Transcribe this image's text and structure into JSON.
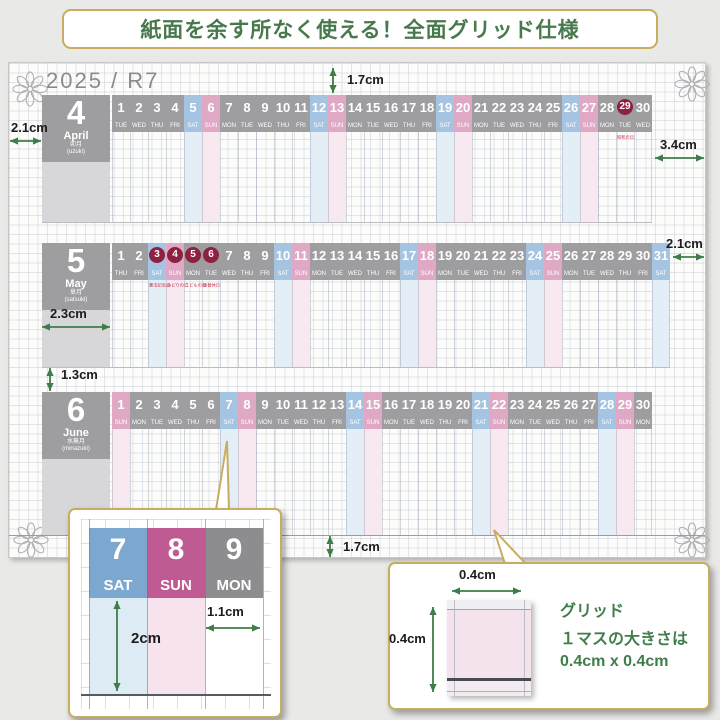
{
  "banner": {
    "text": "紙面を余す所なく使える！全面グリッド仕様"
  },
  "calendar": {
    "year_label": "2025 / R7",
    "months": [
      {
        "num": "4",
        "name_en": "April",
        "name_jp": "卯月",
        "name_romaji": "(uzuki)",
        "holidays": {
          "29": "昭和の日"
        },
        "days": [
          [
            1,
            "TUE"
          ],
          [
            2,
            "WED"
          ],
          [
            3,
            "THU"
          ],
          [
            4,
            "FRI"
          ],
          [
            5,
            "SAT"
          ],
          [
            6,
            "SUN"
          ],
          [
            7,
            "MON"
          ],
          [
            8,
            "TUE"
          ],
          [
            9,
            "WED"
          ],
          [
            10,
            "THU"
          ],
          [
            11,
            "FRI"
          ],
          [
            12,
            "SAT"
          ],
          [
            13,
            "SUN"
          ],
          [
            14,
            "MON"
          ],
          [
            15,
            "TUE"
          ],
          [
            16,
            "WED"
          ],
          [
            17,
            "THU"
          ],
          [
            18,
            "FRI"
          ],
          [
            19,
            "SAT"
          ],
          [
            20,
            "SUN"
          ],
          [
            21,
            "MON"
          ],
          [
            22,
            "TUE"
          ],
          [
            23,
            "WED"
          ],
          [
            24,
            "THU"
          ],
          [
            25,
            "FRI"
          ],
          [
            26,
            "SAT"
          ],
          [
            27,
            "SUN"
          ],
          [
            28,
            "MON"
          ],
          [
            29,
            "TUE"
          ],
          [
            30,
            "WED"
          ]
        ]
      },
      {
        "num": "5",
        "name_en": "May",
        "name_jp": "皐月",
        "name_romaji": "(satsuki)",
        "holidays": {
          "3": "憲法記念日",
          "4": "みどりの日",
          "5": "こどもの日",
          "6": "振替休日"
        },
        "days": [
          [
            1,
            "THU"
          ],
          [
            2,
            "FRI"
          ],
          [
            3,
            "SAT"
          ],
          [
            4,
            "SUN"
          ],
          [
            5,
            "MON"
          ],
          [
            6,
            "TUE"
          ],
          [
            7,
            "WED"
          ],
          [
            8,
            "THU"
          ],
          [
            9,
            "FRI"
          ],
          [
            10,
            "SAT"
          ],
          [
            11,
            "SUN"
          ],
          [
            12,
            "MON"
          ],
          [
            13,
            "TUE"
          ],
          [
            14,
            "WED"
          ],
          [
            15,
            "THU"
          ],
          [
            16,
            "FRI"
          ],
          [
            17,
            "SAT"
          ],
          [
            18,
            "SUN"
          ],
          [
            19,
            "MON"
          ],
          [
            20,
            "TUE"
          ],
          [
            21,
            "WED"
          ],
          [
            22,
            "THU"
          ],
          [
            23,
            "FRI"
          ],
          [
            24,
            "SAT"
          ],
          [
            25,
            "SUN"
          ],
          [
            26,
            "MON"
          ],
          [
            27,
            "TUE"
          ],
          [
            28,
            "WED"
          ],
          [
            29,
            "THU"
          ],
          [
            30,
            "FRI"
          ],
          [
            31,
            "SAT"
          ]
        ]
      },
      {
        "num": "6",
        "name_en": "June",
        "name_jp": "水無月",
        "name_romaji": "(minazuki)",
        "holidays": {},
        "days": [
          [
            1,
            "SUN"
          ],
          [
            2,
            "MON"
          ],
          [
            3,
            "TUE"
          ],
          [
            4,
            "WED"
          ],
          [
            5,
            "THU"
          ],
          [
            6,
            "FRI"
          ],
          [
            7,
            "SAT"
          ],
          [
            8,
            "SUN"
          ],
          [
            9,
            "MON"
          ],
          [
            10,
            "TUE"
          ],
          [
            11,
            "WED"
          ],
          [
            12,
            "THU"
          ],
          [
            13,
            "FRI"
          ],
          [
            14,
            "SAT"
          ],
          [
            15,
            "SUN"
          ],
          [
            16,
            "MON"
          ],
          [
            17,
            "TUE"
          ],
          [
            18,
            "WED"
          ],
          [
            19,
            "THU"
          ],
          [
            20,
            "FRI"
          ],
          [
            21,
            "SAT"
          ],
          [
            22,
            "SUN"
          ],
          [
            23,
            "MON"
          ],
          [
            24,
            "TUE"
          ],
          [
            25,
            "WED"
          ],
          [
            26,
            "THU"
          ],
          [
            27,
            "FRI"
          ],
          [
            28,
            "SAT"
          ],
          [
            29,
            "SUN"
          ],
          [
            30,
            "MON"
          ]
        ]
      }
    ]
  },
  "measurements": {
    "top_margin": "1.7cm",
    "left_margin": "2.1cm",
    "right_margin_april": "3.4cm",
    "right_margin_may": "2.1cm",
    "month_column_width": "2.3cm",
    "row_gap": "1.3cm",
    "bottom_margin": "1.7cm"
  },
  "inset_zoom": {
    "cells": [
      {
        "num": "7",
        "dow": "SAT"
      },
      {
        "num": "8",
        "dow": "SUN"
      },
      {
        "num": "9",
        "dow": "MON"
      }
    ],
    "cell_height": "2cm",
    "cell_width": "1.1cm"
  },
  "inset_grid": {
    "cell_width": "0.4cm",
    "cell_height": "0.4cm",
    "text_lines": [
      "グリッド",
      "１マスの大きさは",
      "0.4cm x 0.4cm"
    ]
  },
  "colors": {
    "accent_green": "#3e7d48",
    "gold_border": "#c6ad60",
    "banner_text": "#47794d",
    "header_gray": "#9e9ea0",
    "sat_blue": "#a5c4e1",
    "sun_pink": "#dfa9c5",
    "sat_deep": "#7ca8d0",
    "sun_deep": "#bf5a92",
    "mon_gray": "#8d8d8f",
    "holiday_maroon": "#8e2040",
    "sat_stripe": "#e4eef6",
    "sun_stripe": "#f8e9f1"
  }
}
